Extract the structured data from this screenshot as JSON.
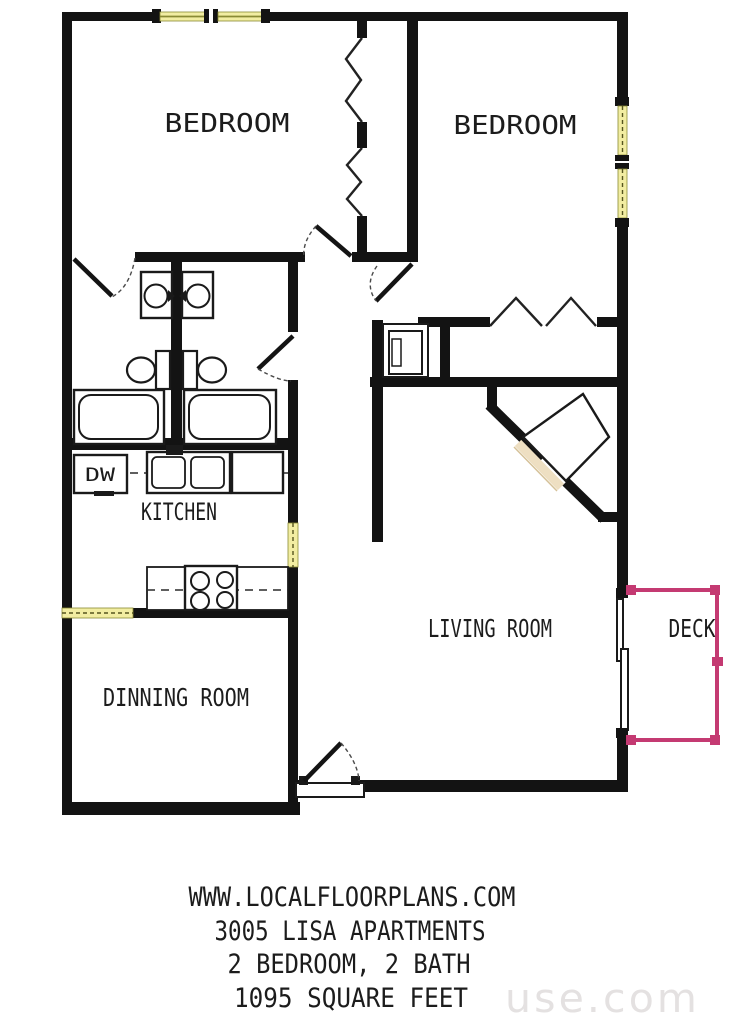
{
  "colors": {
    "bg": "#ffffff",
    "wall": "#131313",
    "win": "#f2eda2",
    "winframe": "#8a8a34",
    "deck": "#c43a72",
    "hearth": "#eedfc2",
    "ink": "#1c1c1c",
    "wm": "#e4e1e1"
  },
  "rooms": {
    "bedroom_left": {
      "label": "BEDROOM"
    },
    "bedroom_right": {
      "label": "BEDROOM"
    },
    "kitchen": {
      "label": "KITCHEN"
    },
    "dining": {
      "label": "DINNING ROOM"
    },
    "living": {
      "label": "LIVING ROOM"
    },
    "deck": {
      "label": "DECK"
    }
  },
  "fixtures": {
    "dishwasher_label": "DW"
  },
  "footer": {
    "line1": "WWW.LOCALFLOORPLANS.COM",
    "line2": "3005 LISA APARTMENTS",
    "line3": "2 BEDROOM, 2 BATH",
    "line4": "1095 SQUARE FEET"
  },
  "watermark": {
    "text": "use.com"
  }
}
